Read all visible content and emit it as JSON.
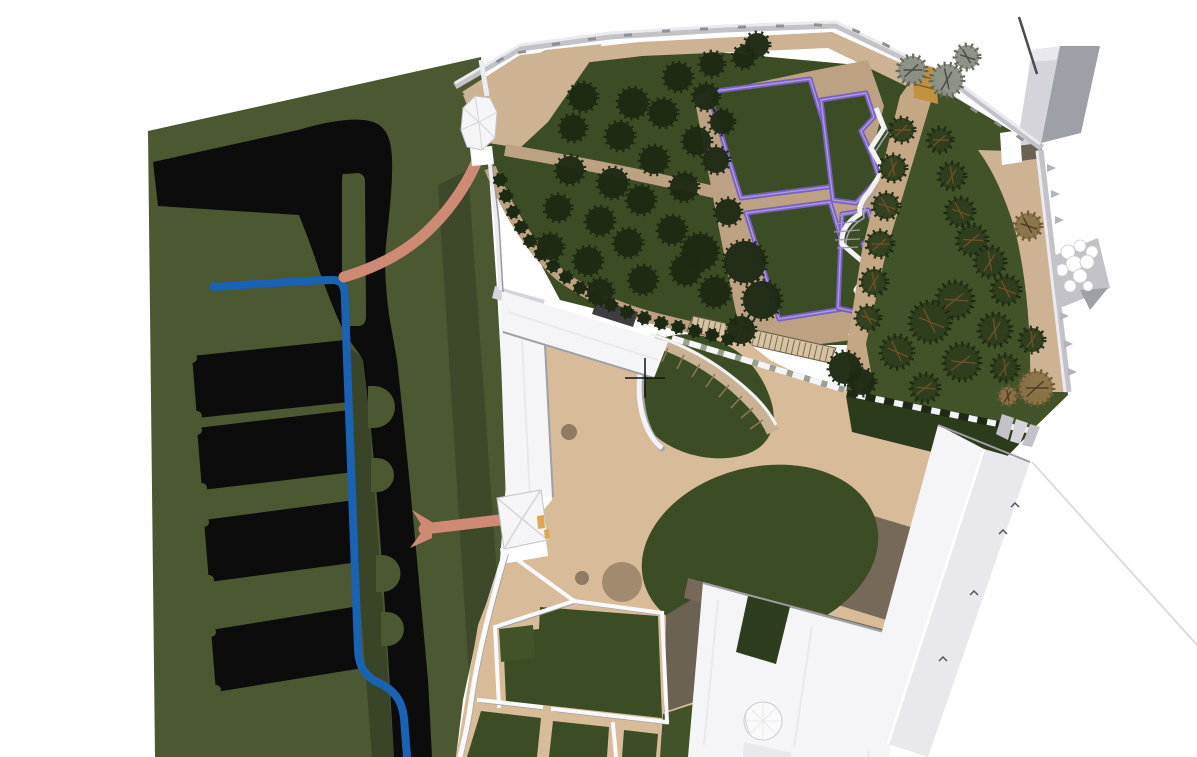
{
  "scene": {
    "description": "3D aerial CAD model view of a palace estate: west field with black parterre plots and blue canal, walled orchard with tree rows, purple-edged privy garden beds, tan courtyards with oval lawn, white palace buildings and boundary walls",
    "cursor": {
      "x": 645,
      "y": 378
    }
  },
  "palette": {
    "field-green": "#4b5832",
    "lawn": "#3c4d26",
    "lawn-2": "#42532a",
    "lawn-dark": "#2d3b1d",
    "court-green": "#2e3d1e",
    "ink": "#0c0c0c",
    "canal": "#1a62b3",
    "pink": "#cf8a75",
    "plaza": "#d8bc99",
    "path": "#bca183",
    "band": "#cdb394",
    "avenue": "#c4a886",
    "terrace": "#6c6253",
    "terrace-2": "#77695a",
    "spot": "#a18a6e",
    "spot-dark": "#8f7a62",
    "purple": "#7b60c4",
    "purple-light": "#a99ce0",
    "roof": "#f5f5f7",
    "roof-mid": "#e9e9ed",
    "roof-dark": "#d4d4da",
    "wall-gray": "#c2c2c8",
    "side-gray": "#9da0a6",
    "charcoal": "#3d3d42",
    "amber": "#dfa64f",
    "gold": "#bf9140",
    "tree-dark": "#1e2913",
    "tree-mid": "#2f3e1c",
    "tree-gray": "#8b9084",
    "tree-brown": "#8a7347",
    "branch": "#6e4f28"
  },
  "vegetation": {
    "orchard_trees": [
      [
        583,
        97,
        14
      ],
      [
        633,
        103,
        15
      ],
      [
        678,
        77,
        14
      ],
      [
        712,
        64,
        12
      ],
      [
        573,
        128,
        13
      ],
      [
        620,
        136,
        14
      ],
      [
        663,
        113,
        14
      ],
      [
        706,
        97,
        13
      ],
      [
        570,
        170,
        14
      ],
      [
        613,
        183,
        15
      ],
      [
        654,
        160,
        14
      ],
      [
        697,
        141,
        14
      ],
      [
        558,
        208,
        13
      ],
      [
        600,
        221,
        14
      ],
      [
        641,
        200,
        14
      ],
      [
        684,
        187,
        14
      ],
      [
        550,
        247,
        13
      ],
      [
        588,
        261,
        14
      ],
      [
        628,
        243,
        14
      ],
      [
        672,
        230,
        14
      ],
      [
        600,
        292,
        13
      ],
      [
        643,
        280,
        14
      ],
      [
        686,
        270,
        15
      ],
      [
        716,
        160,
        13
      ],
      [
        722,
        122,
        12
      ],
      [
        728,
        212,
        13
      ],
      [
        744,
        57,
        11
      ],
      [
        757,
        45,
        12
      ],
      [
        700,
        252,
        18
      ],
      [
        745,
        262,
        21
      ],
      [
        762,
        300,
        19
      ],
      [
        715,
        292,
        15
      ],
      [
        741,
        330,
        14
      ],
      [
        845,
        368,
        16
      ],
      [
        862,
        382,
        13
      ]
    ],
    "hedge_bushes": [
      [
        500,
        180
      ],
      [
        506,
        196
      ],
      [
        513,
        212
      ],
      [
        521,
        227
      ],
      [
        530,
        241
      ],
      [
        541,
        254
      ],
      [
        553,
        266
      ],
      [
        566,
        277
      ],
      [
        580,
        288
      ],
      [
        595,
        297
      ],
      [
        611,
        305
      ],
      [
        627,
        312
      ],
      [
        644,
        318
      ],
      [
        661,
        323
      ],
      [
        678,
        327
      ],
      [
        695,
        331
      ],
      [
        712,
        335
      ],
      [
        728,
        339
      ]
    ],
    "garden_trees": [
      [
        902,
        130,
        12
      ],
      [
        893,
        168,
        13
      ],
      [
        886,
        206,
        13
      ],
      [
        880,
        244,
        13
      ],
      [
        874,
        282,
        13
      ],
      [
        868,
        318,
        12
      ],
      [
        940,
        140,
        12
      ],
      [
        952,
        176,
        13
      ],
      [
        960,
        212,
        14
      ],
      [
        972,
        240,
        15
      ],
      [
        990,
        262,
        15
      ],
      [
        1006,
        290,
        14
      ],
      [
        955,
        300,
        18
      ],
      [
        995,
        330,
        16
      ],
      [
        930,
        322,
        20
      ],
      [
        962,
        362,
        18
      ],
      [
        1005,
        368,
        13
      ],
      [
        897,
        352,
        16
      ],
      [
        925,
        388,
        14
      ],
      [
        1032,
        340,
        12
      ]
    ],
    "brown_trees": [
      [
        1036,
        388,
        17
      ],
      [
        1008,
        396,
        9
      ],
      [
        1028,
        226,
        13
      ]
    ],
    "gray_trees": [
      [
        912,
        70,
        14
      ],
      [
        947,
        80,
        16
      ],
      [
        967,
        57,
        12
      ]
    ]
  },
  "wall_details": {
    "merlons": [
      [
        500,
        60,
        -30
      ],
      [
        522,
        52,
        -8
      ],
      [
        556,
        44,
        -7
      ],
      [
        592,
        39,
        -5
      ],
      [
        628,
        35,
        -4
      ],
      [
        666,
        31,
        -3
      ],
      [
        704,
        29,
        -2
      ],
      [
        742,
        27,
        -1
      ],
      [
        780,
        26,
        0
      ],
      [
        818,
        25,
        3
      ],
      [
        856,
        31,
        22
      ],
      [
        886,
        45,
        28
      ],
      [
        950,
        95,
        35
      ],
      [
        974,
        110,
        35
      ],
      [
        998,
        124,
        35
      ],
      [
        1020,
        138,
        35
      ]
    ],
    "buttresses": [
      [
        1047,
        168
      ],
      [
        1051,
        194
      ],
      [
        1055,
        220
      ],
      [
        1060,
        316
      ],
      [
        1064,
        344
      ],
      [
        1068,
        372
      ]
    ]
  },
  "birds": [
    [
      1015,
      505
    ],
    [
      1003,
      532
    ],
    [
      974,
      593
    ],
    [
      943,
      659
    ]
  ]
}
